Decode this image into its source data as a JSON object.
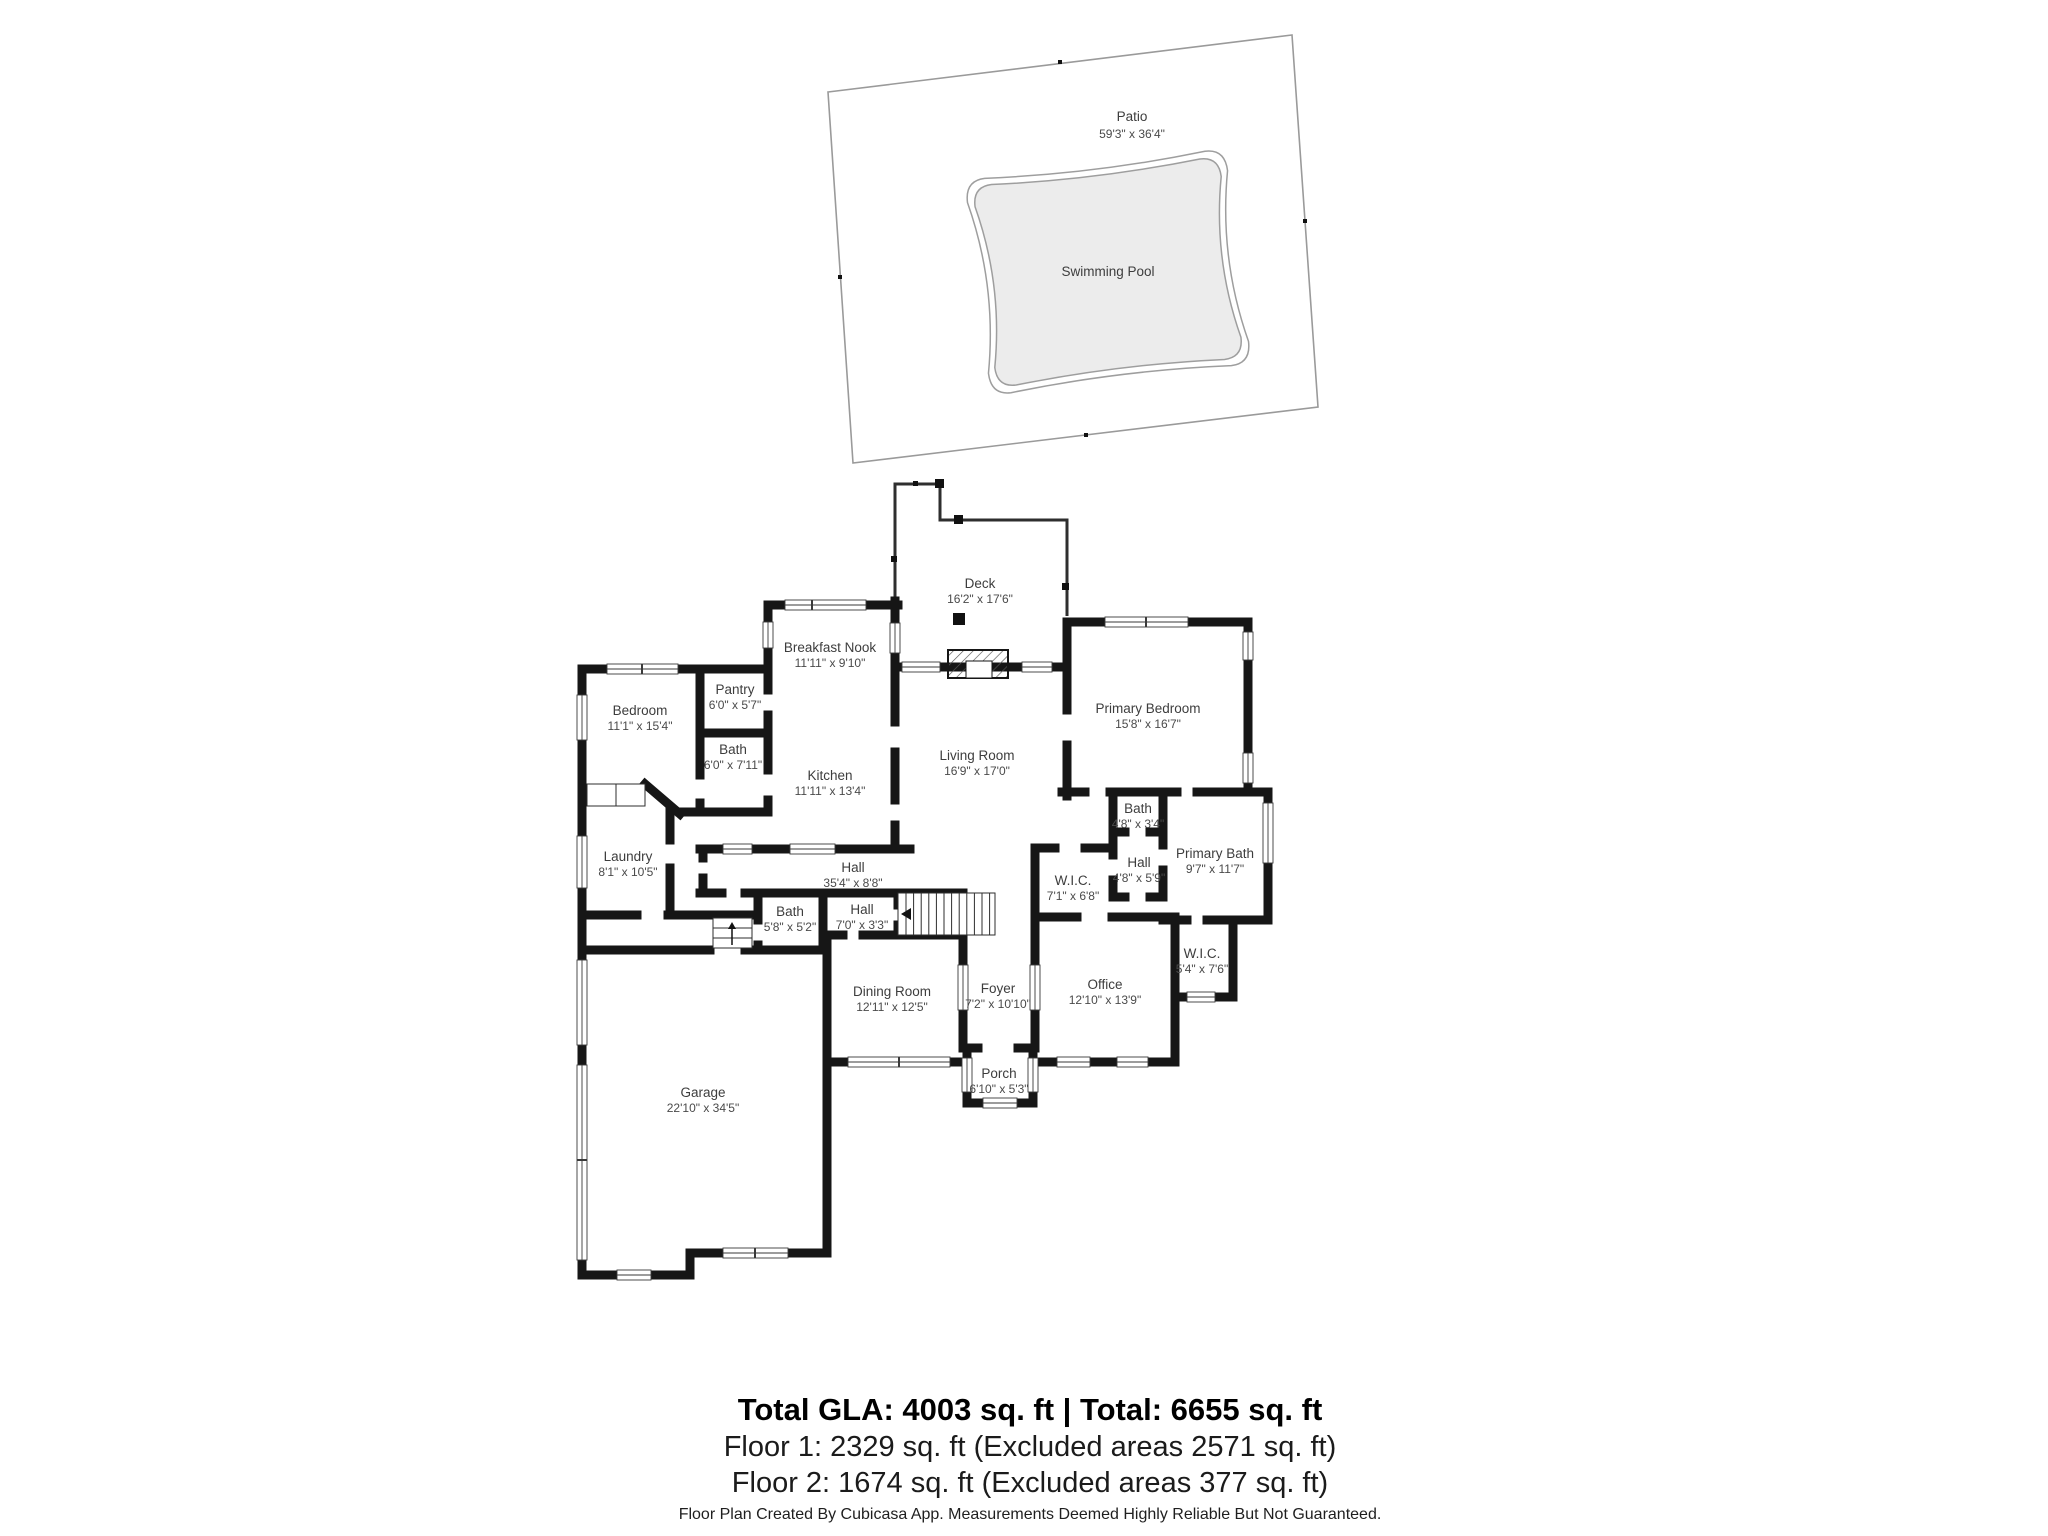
{
  "patio": {
    "name": "Patio",
    "dims": "59'3\" x 36'4\""
  },
  "pool": {
    "name": "Swimming Pool"
  },
  "rooms": [
    {
      "id": "deck",
      "name": "Deck",
      "dims": "16'2\" x 17'6\""
    },
    {
      "id": "breakfast_nook",
      "name": "Breakfast Nook",
      "dims": "11'11\" x 9'10\""
    },
    {
      "id": "pantry",
      "name": "Pantry",
      "dims": "6'0\" x 5'7\""
    },
    {
      "id": "bedroom",
      "name": "Bedroom",
      "dims": "11'1\" x 15'4\""
    },
    {
      "id": "bath1",
      "name": "Bath",
      "dims": "6'0\" x 7'11\""
    },
    {
      "id": "kitchen",
      "name": "Kitchen",
      "dims": "11'11\" x 13'4\""
    },
    {
      "id": "living_room",
      "name": "Living Room",
      "dims": "16'9\" x 17'0\""
    },
    {
      "id": "primary_bedroom",
      "name": "Primary Bedroom",
      "dims": "15'8\" x 16'7\""
    },
    {
      "id": "bath2",
      "name": "Bath",
      "dims": "4'8\" x 3'4\""
    },
    {
      "id": "hall2",
      "name": "Hall",
      "dims": "4'8\" x 5'9\""
    },
    {
      "id": "primary_bath",
      "name": "Primary Bath",
      "dims": "9'7\" x 11'7\""
    },
    {
      "id": "wic1",
      "name": "W.I.C.",
      "dims": "7'1\" x 6'8\""
    },
    {
      "id": "hall1",
      "name": "Hall",
      "dims": "35'4\" x 8'8\""
    },
    {
      "id": "laundry",
      "name": "Laundry",
      "dims": "8'1\" x 10'5\""
    },
    {
      "id": "bath3",
      "name": "Bath",
      "dims": "5'8\" x 5'2\""
    },
    {
      "id": "hall3",
      "name": "Hall",
      "dims": "7'0\" x 3'3\""
    },
    {
      "id": "wic2",
      "name": "W.I.C.",
      "dims": "5'4\" x 7'6\""
    },
    {
      "id": "office",
      "name": "Office",
      "dims": "12'10\" x 13'9\""
    },
    {
      "id": "dining_room",
      "name": "Dining Room",
      "dims": "12'11\" x 12'5\""
    },
    {
      "id": "foyer",
      "name": "Foyer",
      "dims": "7'2\" x 10'10\""
    },
    {
      "id": "porch",
      "name": "Porch",
      "dims": "6'10\" x 5'3\""
    },
    {
      "id": "garage",
      "name": "Garage",
      "dims": "22'10\" x 34'5\""
    }
  ],
  "summary": {
    "line1": "Total GLA: 4003 sq. ft | Total: 6655 sq. ft",
    "line2": "Floor 1: 2329 sq. ft (Excluded areas 2571 sq. ft)",
    "line3": "Floor 2: 1674 sq. ft (Excluded areas 377 sq. ft)"
  },
  "footer": "Floor Plan Created By Cubicasa App. Measurements Deemed Highly Reliable But Not Guaranteed.",
  "colors": {
    "wall": "#161616",
    "thin_line": "#2e2e2e",
    "patio_outline": "#9a9a9a",
    "pool_fill": "#ececec",
    "pool_outline": "#9e9e9e",
    "label_text": "#3d3d3d"
  }
}
